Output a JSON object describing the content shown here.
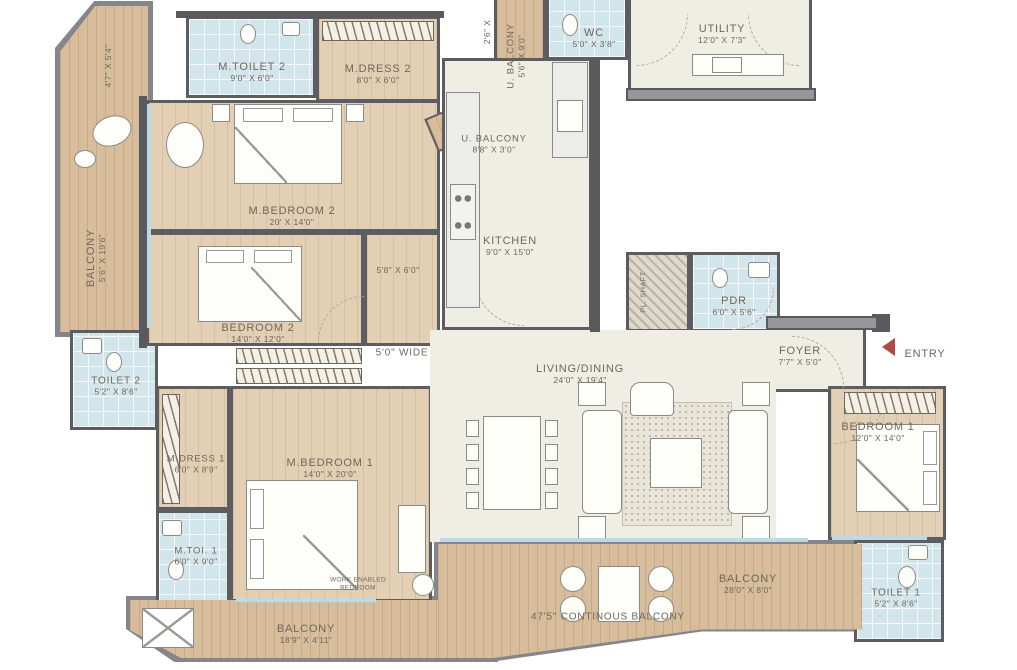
{
  "rooms": {
    "m_toilet_2": {
      "name": "M.TOILET 2",
      "dims": "9'0\" X 6'0\""
    },
    "m_dress_2": {
      "name": "M.DRESS 2",
      "dims": "8'0\" X 6'0\""
    },
    "m_bedroom_2": {
      "name": "M.BEDROOM 2",
      "dims": "20' X 14'0\""
    },
    "bedroom_2": {
      "name": "BEDROOM 2",
      "dims": "14'0\" X 12'0\""
    },
    "balcony_left": {
      "name": "BALCONY",
      "dims": "5'6\" X 19'6\""
    },
    "wc": {
      "name": "WC",
      "dims": "5'0\" X 3'8\""
    },
    "utility": {
      "name": "UTILITY",
      "dims": "12'0\" X 7'3\""
    },
    "u_balcony_side": {
      "name": "U. BALCONY",
      "dims": "5'6\" X 9'0\""
    },
    "u_balcony_front": {
      "name": "U. BALCONY",
      "dims": "8'8\" X 3'0\""
    },
    "kitchen": {
      "name": "KITCHEN",
      "dims": "9'0\" X 15'0\""
    },
    "pl_shaft": {
      "name": "PL. SHAFT",
      "dims": ""
    },
    "pdr": {
      "name": "PDR",
      "dims": "6'0\" X 5'6\""
    },
    "living_dining": {
      "name": "LIVING/DINING",
      "dims": "24'0\" X 19'4\""
    },
    "foyer": {
      "name": "FOYER",
      "dims": "7'7\" X 5'0\""
    },
    "toilet_2": {
      "name": "TOILET 2",
      "dims": "5'2\" X 8'6\""
    },
    "m_dress_1": {
      "name": "M.DRESS 1",
      "dims": "6'0\" X 8'9\""
    },
    "m_bedroom_1": {
      "name": "M.BEDROOM 1",
      "dims": "14'0\" X 20'0\""
    },
    "m_toi_1": {
      "name": "M.TOI. 1",
      "dims": "6'0\" X 9'0\""
    },
    "bedroom_1": {
      "name": "BEDROOM 1",
      "dims": "12'0\" X 14'0\""
    },
    "toilet_1": {
      "name": "TOILET 1",
      "dims": "5'2\" X 8'6\""
    },
    "balcony_bottom_left": {
      "name": "BALCONY",
      "dims": "18'9\" X 4'11\""
    },
    "balcony_bottom_right": {
      "name": "BALCONY",
      "dims": "28'0\" X 8'0\""
    }
  },
  "annotations": {
    "entry": "ENTRY",
    "continuous_balcony": "47'5\" CONTINOUS BALCONY",
    "passage_width": "5'0\" WIDE",
    "passage_dim": "5'8\" X 6'0\"",
    "work_note_line1": "WORK ENABLED",
    "work_note_line2": "BEDROOM",
    "dim_left": "4'7\" X 5'4\"",
    "dim_top": "2'6\" X"
  },
  "colors": {
    "wall": "#5a5a5e",
    "wood_balcony": "#d8bd9d",
    "wood_room": "#e3cfb3",
    "bath_tile": "#d2e5ea",
    "living_floor": "#efeee4",
    "entry_arrow": "#b04a42",
    "label_text": "#6e675c"
  }
}
